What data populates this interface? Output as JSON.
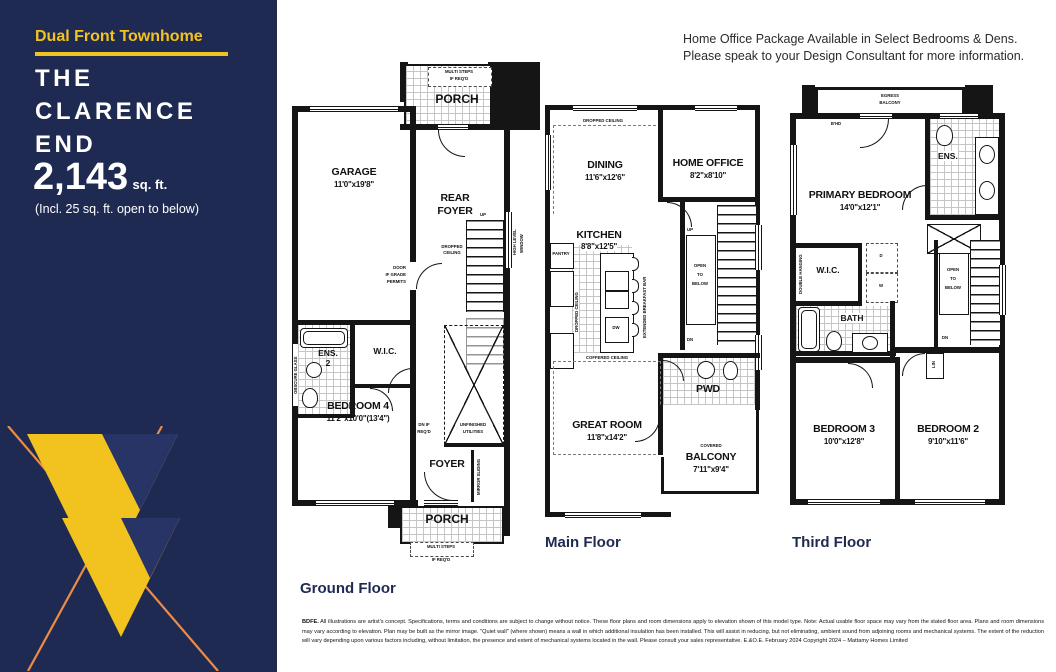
{
  "brand": {
    "navy": "#1f2a52",
    "yellow": "#f2c31e",
    "orange": "#ee8b45"
  },
  "sidebar": {
    "tagline": "Dual Front Townhome",
    "title": "THE\nCLARENCE\nEND",
    "area_value": "2,143",
    "area_unit": "sq. ft.",
    "area_note": "(Incl. 25 sq. ft. open to below)"
  },
  "header": {
    "line1": "Home Office Package Available in Select Bedrooms & Dens.",
    "line2": "Please speak to your Design Consultant for more information."
  },
  "ground": {
    "label": "Ground Floor",
    "porch_top": "PORCH",
    "porch_bottom": "PORCH",
    "steps_note1": "MULTI STEPS",
    "steps_note2": "IF REQ'D",
    "garage": "GARAGE",
    "garage_dims": "11'0\"x19'8\"",
    "rear_foyer1": "REAR",
    "rear_foyer2": "FOYER",
    "dropped1": "DROPPED",
    "dropped2": "CEILING",
    "door_grade1": "DOOR",
    "door_grade2": "IF GRADE",
    "door_grade3": "PERMITS",
    "up": "UP",
    "high_window1": "HIGH LEVEL",
    "high_window2": "WINDOW",
    "wic": "W.I.C.",
    "ens": "ENS.",
    "ens_num": "2",
    "obscure_glass": "OBSCURE GLASS",
    "bedroom4": "BEDROOM 4",
    "bedroom4_dims": "11'2\"x10'0\"(13'4\")",
    "unfinished1": "UNFINISHED",
    "unfinished2": "UTILITIES",
    "dn_note1": "DN IF",
    "dn_note2": "REQ'D",
    "foyer": "FOYER",
    "mirror_sliding": "MIRROR SLIDING"
  },
  "main": {
    "label": "Main Floor",
    "dropped_ceiling": "DROPPED CEILING",
    "dining": "DINING",
    "dining_dims": "11'6\"x12'6\"",
    "home_office": "HOME OFFICE",
    "home_office_dims": "8'2\"x8'10\"",
    "kitchen": "KITCHEN",
    "kitchen_dims": "8'8\"x12'5\"",
    "pantry": "PANTRY",
    "dropped_vert": "DROPPED CEILING",
    "breakfast_bar": "EXTENDED BREAKFAST BAR",
    "dw": "DW",
    "up": "UP",
    "dn": "DN",
    "open1": "OPEN",
    "open2": "TO",
    "open3": "BELOW",
    "coffered": "COFFERED CEILING",
    "great_room": "GREAT ROOM",
    "great_room_dims": "11'8\"x14'2\"",
    "pwd": "PWD",
    "covered": "COVERED",
    "balcony": "BALCONY",
    "balcony_dims": "7'11\"x9'4\""
  },
  "third": {
    "label": "Third Floor",
    "egress1": "EGRESS",
    "egress2": "BALCONY",
    "bhd": "B'HD",
    "primary": "PRIMARY BEDROOM",
    "primary_dims": "14'0\"x12'1\"",
    "ens": "ENS.",
    "wic": "W.I.C.",
    "double_hanging": "DOUBLE HANGING",
    "dryer": "D",
    "washer": "W",
    "bath": "BATH",
    "open1": "OPEN",
    "open2": "TO",
    "open3": "BELOW",
    "dn": "DN",
    "lin": "LIN",
    "bedroom3": "BEDROOM 3",
    "bedroom3_dims": "10'0\"x12'8\"",
    "bedroom2": "BEDROOM 2",
    "bedroom2_dims": "9'10\"x11'6\""
  },
  "disclaimer": {
    "code": "BDFE.",
    "text": " All illustrations are artist's concept. Specifications, terms and conditions are subject to change without notice. These floor plans and room dimensions apply to elevation shown of this model type. Note: Actual usable floor space may vary from the stated floor area. Plans and room dimensions may vary according to elevation. Plan may be built as the mirror image. \"Quiet wall\" (where shown) means a wall in which additional insulation has been installed. This will assist in reducing, but not eliminating, ambient sound from adjoining rooms and mechanical systems. The extent of the reduction will vary depending upon various factors including, without limitation, the presence and extent of mechanical systems located in the wall. Please consult your sales representative.  E.&O.E. February 2024   Copyright 2024 – Mattamy Homes Limited"
  }
}
